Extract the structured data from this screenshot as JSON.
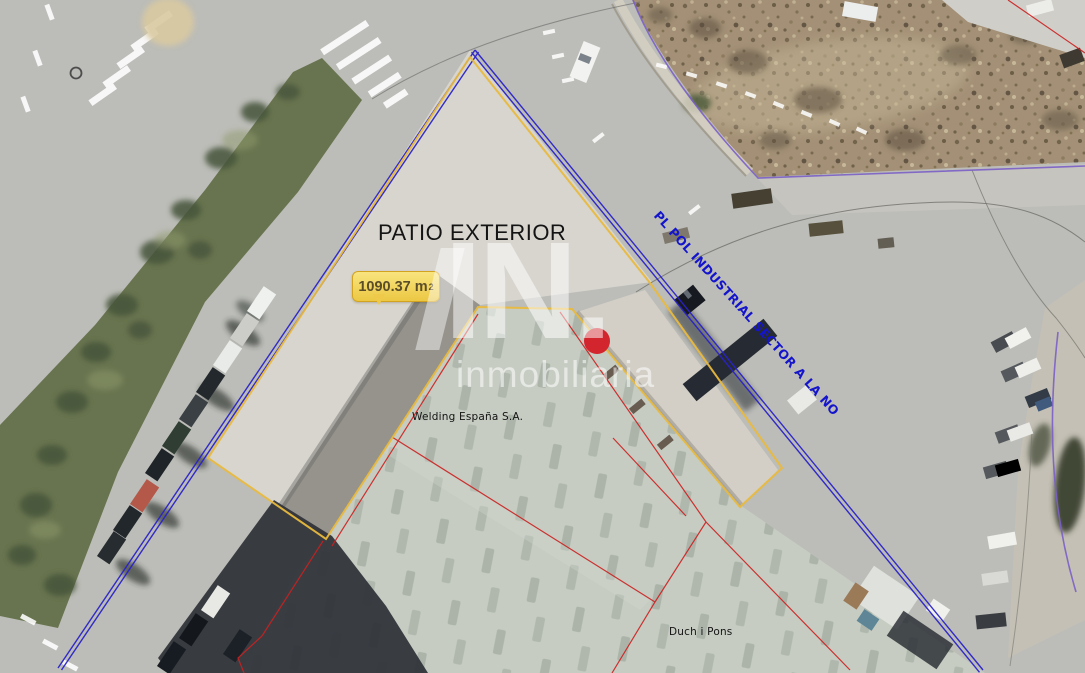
{
  "labels": {
    "patio": "PATIO EXTERIOR",
    "area_value": "1090.37 m",
    "area_exponent": "2",
    "street": "PL POL INDUSTRIAL SECTOR A LA NO",
    "company_top": "Welding España S.A.",
    "company_bottom": "Duch i Pons"
  },
  "watermark": {
    "logo_text": "IN.",
    "brand_text": "inmobiliaria"
  },
  "marker": {
    "name": "property-location-dot",
    "color": "#d2252e",
    "ring": "#a81f26"
  },
  "colors": {
    "parcel_yellow": "#e8b93e",
    "boundary_blue": "#2a22c8",
    "boundary_purple": "#7a5fc6",
    "parcel_red": "#cc2020",
    "road_edge": "#6b6b66",
    "street_label": "#1414cc",
    "area_bubble_text": "#5a4d28",
    "patio_label_text": "#141414"
  }
}
